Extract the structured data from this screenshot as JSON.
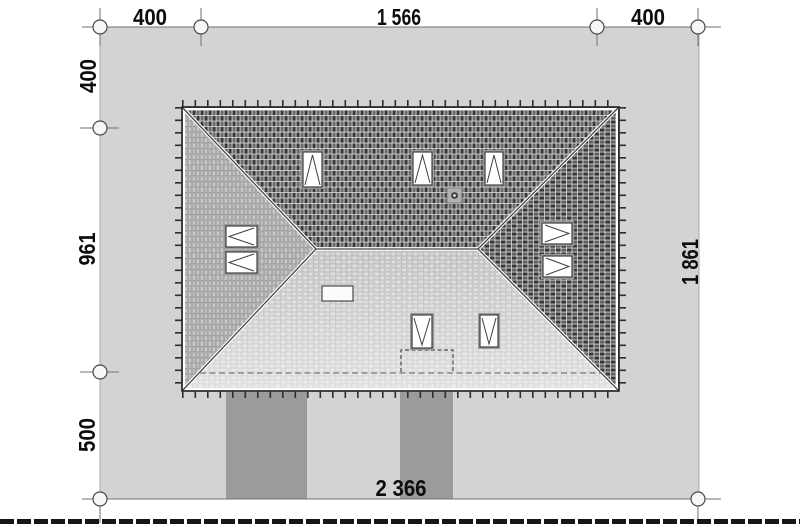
{
  "dimensions": {
    "top_left": "400",
    "top_middle": "1 566",
    "top_right": "400",
    "left_top": "400",
    "left_middle": "961",
    "left_bottom": "500",
    "right_total": "1 861",
    "bottom_total": "2 366"
  },
  "colors": {
    "plot": "#d3d3d3",
    "driveway": "#9b9b9b",
    "dimension_line": "#707070",
    "roof_outline": "#1f1f1f",
    "text": "#0d0d0d"
  },
  "markers": {
    "dimension_node": "circle"
  }
}
